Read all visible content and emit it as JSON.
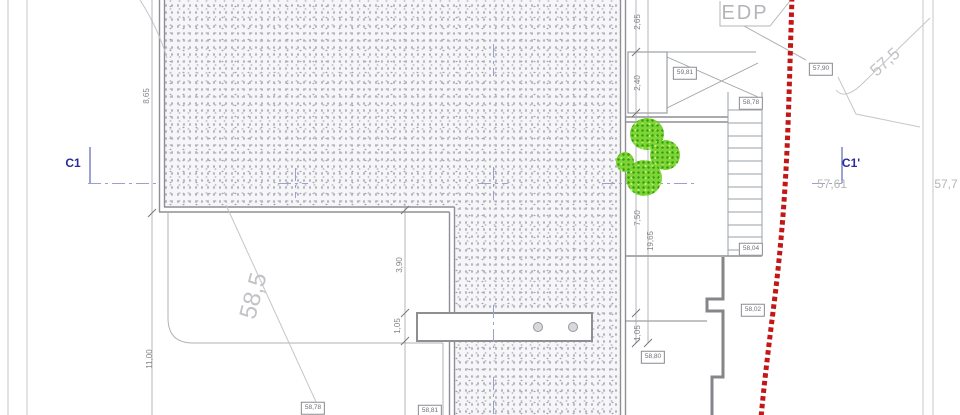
{
  "utility": {
    "edp": "EDP"
  },
  "markers": {
    "left": "C1",
    "right": "C1'"
  },
  "contours": {
    "big": "58,5",
    "upper_right": "57,5",
    "right_1": "57,61",
    "right_2": "57,7"
  },
  "dimensions": {
    "left_top": "8,65",
    "left_bottom": "11,00",
    "top_1": "2,65",
    "top_2": "2,40",
    "mid_right": "7,50",
    "overall_right": "19,65",
    "right_small": "1,05",
    "notch": "3,90",
    "notch_small": "1,05"
  },
  "elevations": {
    "top_right": "57,90",
    "planter": "59,81",
    "stair_top": "58,78",
    "stair_bottom": "58,04",
    "wall_mid": "58,02",
    "center_bottom": "58,80",
    "bottom_left": "58,78",
    "bottom_center": "58,81"
  },
  "colors": {
    "boundary_red": "#c31616",
    "axis_blue": "#9aa0cf",
    "marker_navy": "#2b2b9e",
    "tree_green": "#58c421",
    "line_gray": "#8f8f94"
  }
}
